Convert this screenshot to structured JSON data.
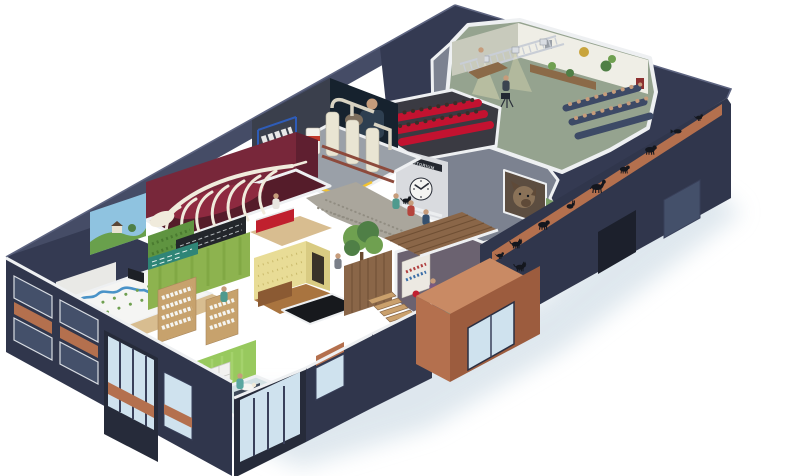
{
  "scene": {
    "description": "Isometric cutaway illustration of an animal / veterinary visitor centre building showing interior rooms",
    "background": "#ffffff"
  },
  "auditorium": {
    "sign": "AUDITORIUM",
    "clock_time": "10:09"
  },
  "frieze": {
    "animals": [
      "cat",
      "dog",
      "rabbit",
      "horse",
      "squirrel",
      "goat",
      "fish",
      "bird"
    ],
    "vestibule_animals": [
      "bird",
      "cat"
    ]
  },
  "rooms": [
    "tv-studio",
    "auditorium",
    "machinery-hall",
    "whale-skeleton-gallery",
    "landscape-mural",
    "hedge-wall",
    "menu-chalkboard",
    "river-floor-exhibit",
    "shop",
    "historic-shop",
    "reception",
    "hallway",
    "cafe",
    "staircase",
    "dog-photo-mural",
    "exam-room",
    "photo-mural-man-with-dog"
  ],
  "palette": {
    "bg": "#ffffff",
    "shadow": "#d7e2ea",
    "band": "#454c66",
    "roof": "#343a52",
    "roof_edge": "#5d6480",
    "wall": "#30364c",
    "wall_dark": "#262b3a",
    "slab_gray": "#7c8290",
    "cut": "#eef0f2",
    "copper": "#b4704e",
    "copper_light": "#c98a64",
    "copper_dark": "#9c5c3e",
    "glass": "#cfe2ee",
    "glass_dark": "#44506a",
    "frame_white": "#d8dce2",
    "mullion": "#39405a",
    "studio_floor": "#95a38f",
    "studio_wall": "#efeee6",
    "studio_wall2": "#c8cabc",
    "truss": "#c9ced6",
    "gold": "#c8a43c",
    "leaf": "#6fa050",
    "leaf_dark": "#4f7f46",
    "seat_navy": "#3d4a66",
    "aud_red": "#c31230",
    "aud_dark": "#3a3a42",
    "facade_gray": "#d9dbdf",
    "signband": "#23272f",
    "door_cream": "#e9e6da",
    "mach_floor": "#9aa0a8",
    "mach_cream": "#e9e5d3",
    "mach_pipe": "#d8d3c2",
    "mach_red": "#8d4a3c",
    "rack_blue": "#2e5cb8",
    "hazard": "#f2c230",
    "tank_red": "#c0392b",
    "whale_wall": "#78273a",
    "whale_wall_dark": "#5f1f30",
    "whale_floor": "#551c2a",
    "whale_accent": "#8e2a40",
    "bone": "#f0ebdc",
    "mural_sky": "#8fc3e0",
    "mural_green": "#69a04c",
    "hedge": "#5f9440",
    "chalk": "#23262b",
    "chalk_text": "#cfd3d6",
    "wall_white": "#f5f5f3",
    "wall_white2": "#e9e9e6",
    "river": "#4a93c8",
    "floor_wood": "#d8bd90",
    "shop_green": "#8db34f",
    "shop_green_dark": "#7aa03e",
    "shop_sign": "#2f8577",
    "shelf_wood": "#c7a26d",
    "yellow_wall": "#e8dc96",
    "yellow_wall2": "#d9cb82",
    "wood_dark": "#8b5a33",
    "floor_brown": "#a9743f",
    "black_room": "#17191d",
    "desk_red": "#c0202e",
    "cobble": "#aaa69c",
    "cobble_dot": "#918d82",
    "trunk": "#6a4a30",
    "plank": "#8a6648",
    "plank_line": "#6f4f34",
    "step_light": "#caa06c",
    "cafe_floor": "#6b6270",
    "chair_red": "#c02030",
    "table_wood": "#8b6a48",
    "rack_cream": "#ece9e2",
    "mural_dogbg": "#5c4d40",
    "dog_fur": "#8a7258",
    "dog_dark": "#5f4a38",
    "grass_patch": "#7ca06a",
    "curtain": "#98c95e",
    "curtain_line": "#a6d36e",
    "cabinet": "#f2f2f0",
    "exam_floor": "#d3e2e4",
    "table_dark": "#3e4a5a",
    "skin": "#c69c7b",
    "silhouette": "#14171e",
    "photo_bg": "#16222e",
    "photo_man": "#2e3f50",
    "photo_dog": "#7d6e5d"
  }
}
